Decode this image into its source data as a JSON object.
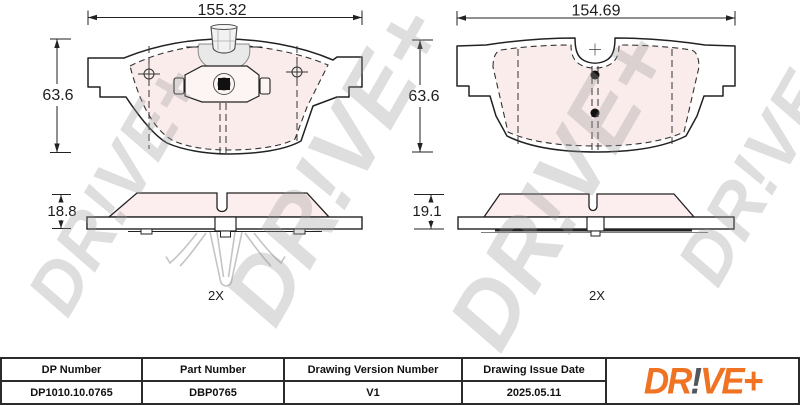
{
  "sheet": {
    "views": {
      "front_left": {
        "width_dim": "155.32",
        "height_dim": "63.6"
      },
      "front_right": {
        "width_dim": "154.69",
        "height_dim": "63.6"
      },
      "side_left": {
        "thickness_dim": "18.8",
        "quantity": "2X"
      },
      "side_right": {
        "thickness_dim": "19.1",
        "quantity": "2X"
      }
    },
    "watermark": "DR!VE+",
    "title_block": {
      "dp_number": {
        "label": "DP Number",
        "value": "DP1010.10.0765"
      },
      "part_number": {
        "label": "Part Number",
        "value": "DBP0765"
      },
      "drawing_version": {
        "label": "Drawing Version Number",
        "value": "V1"
      },
      "issue_date": {
        "label": "Drawing Issue Date",
        "value": "2025.05.11"
      }
    },
    "logo": {
      "dr": "DR",
      "bang": "!",
      "ve_plus": "VE+"
    },
    "colors": {
      "accent_orange": "#EF7322",
      "logo_gray": "#55565A",
      "friction_pink": "#FBECEC",
      "line": "#222222"
    }
  }
}
